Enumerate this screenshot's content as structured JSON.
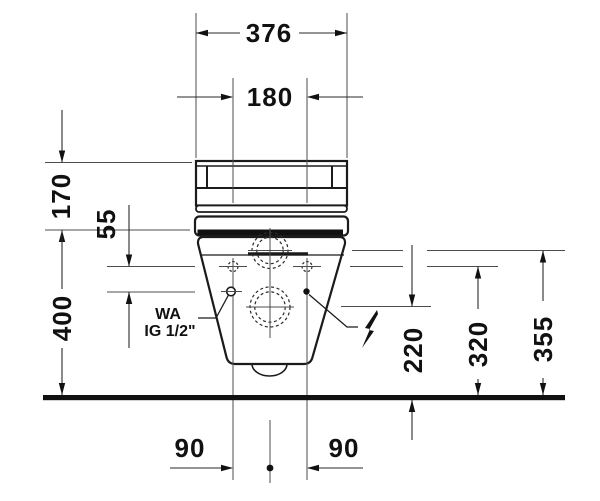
{
  "dimensions": {
    "overall_width": "376",
    "fixing_hole_spacing": "180",
    "cover_height": "170",
    "connection_offset": "55",
    "ceramic_top_height": "400",
    "outlet_height": "220",
    "fixing_hole_height": "320",
    "inlet_height": "355",
    "hole_offset_left": "90",
    "hole_offset_right": "90"
  },
  "annotations": {
    "water_line1": "WA",
    "water_line2": "IG 1/2\""
  },
  "icons": {
    "electrical": "lightning-bolt"
  },
  "colors": {
    "ink": "#1b1b1b",
    "paper": "#ffffff"
  }
}
